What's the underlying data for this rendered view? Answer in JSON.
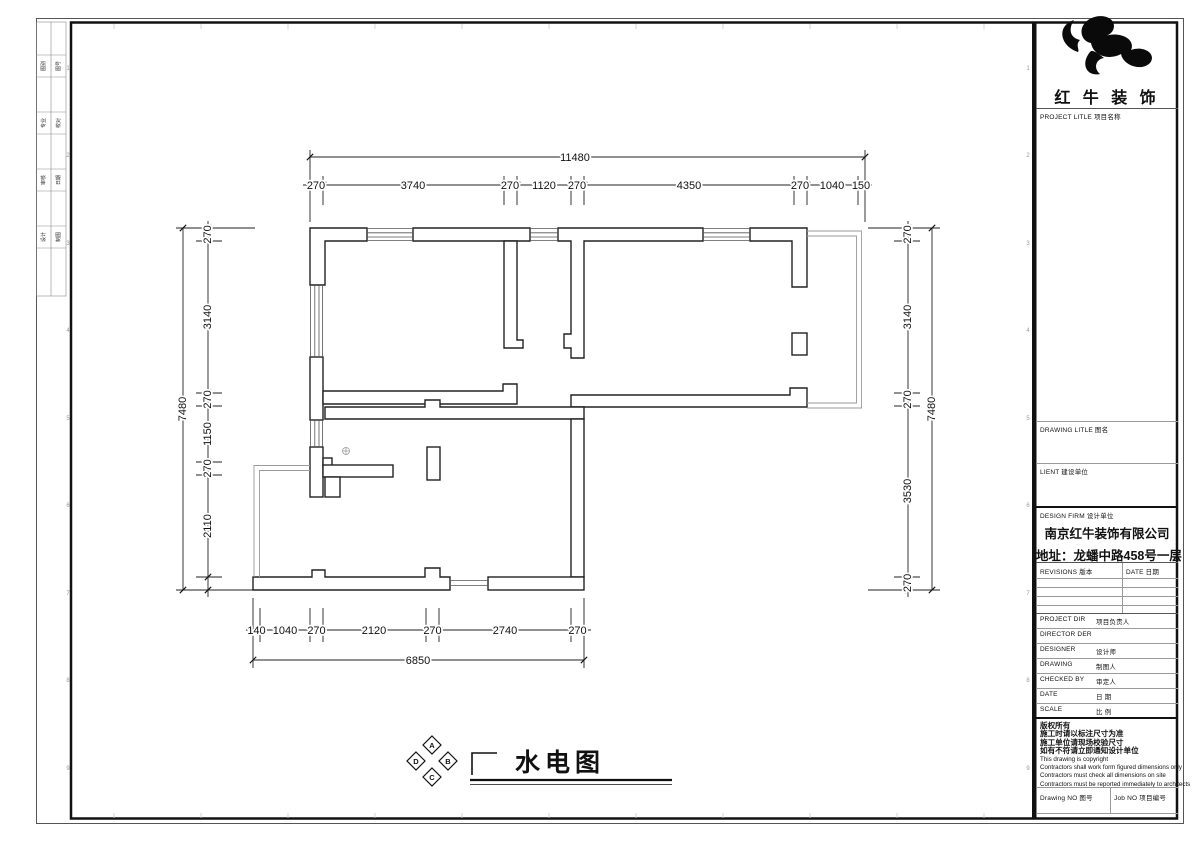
{
  "plan": {
    "drawing_title": "水电图",
    "compass": {
      "top": "A",
      "right": "B",
      "bottom": "C",
      "left": "D"
    },
    "dimensions": {
      "top": {
        "total": "11480",
        "segments": [
          "270",
          "3740",
          "270",
          "1120",
          "270",
          "4350",
          "270",
          "1040",
          "150"
        ]
      },
      "left": {
        "total": "7480",
        "segments": [
          "270",
          "3140",
          "270",
          "1150",
          "270",
          "2110"
        ]
      },
      "right": {
        "total": "7480",
        "segments": [
          "270",
          "3140",
          "270",
          "3530",
          "270"
        ]
      },
      "bottom": {
        "total": "6850",
        "segments": [
          "140",
          "1040",
          "270",
          "2120",
          "270",
          "2740",
          "270"
        ]
      }
    }
  },
  "sign_strip": {
    "rows": [
      {
        "left": "图别",
        "right": "图号"
      },
      {
        "left": "专业",
        "right": "校对"
      },
      {
        "left": "审核",
        "right": "日期"
      },
      {
        "left": "设计",
        "right": "制图"
      }
    ]
  },
  "frame": {
    "row_numbers": [
      "1",
      "2",
      "3",
      "4",
      "5",
      "6",
      "7",
      "8",
      "9"
    ]
  },
  "title_block": {
    "brand": "红 牛 装 饰",
    "project_title_label": "PROJECT LITLE  项目名称",
    "drawing_title_label": "DRAWING LITLE  图名",
    "client_label": "LIENT  建设单位",
    "design_firm_label": "DESIGN FIRM  设计单位",
    "firm_name": "南京红牛装饰有限公司",
    "firm_address": "地址：龙蟠中路458号一层",
    "revisions_label": "REVISIONS 版本",
    "date_col_label": "DATE 日期",
    "rows": [
      {
        "en": "PROJECT DIR",
        "cn": "项目负责人"
      },
      {
        "en": "DIRECTOR DER",
        "cn": ""
      },
      {
        "en": "DESIGNER",
        "cn": "设计师"
      },
      {
        "en": "DRAWING",
        "cn": "制图人"
      },
      {
        "en": "CHECKED BY",
        "cn": "审定人"
      },
      {
        "en": "DATE",
        "cn": "日 期"
      },
      {
        "en": "SCALE",
        "cn": "比 例"
      }
    ],
    "copyright_lines": [
      "版权所有",
      "施工时请以标注尺寸为准",
      "施工单位请现场校验尺寸",
      "如有不符请立即通知设计单位",
      "This drawing is copyright",
      "Contractors shall work form figured dimensions only",
      "Contractors must check all dimensions on site",
      "Contractors must be reported immediately to architects"
    ],
    "drawing_no_label": "Drawing NO  图号",
    "job_no_label": "Job NO  项目编号"
  }
}
